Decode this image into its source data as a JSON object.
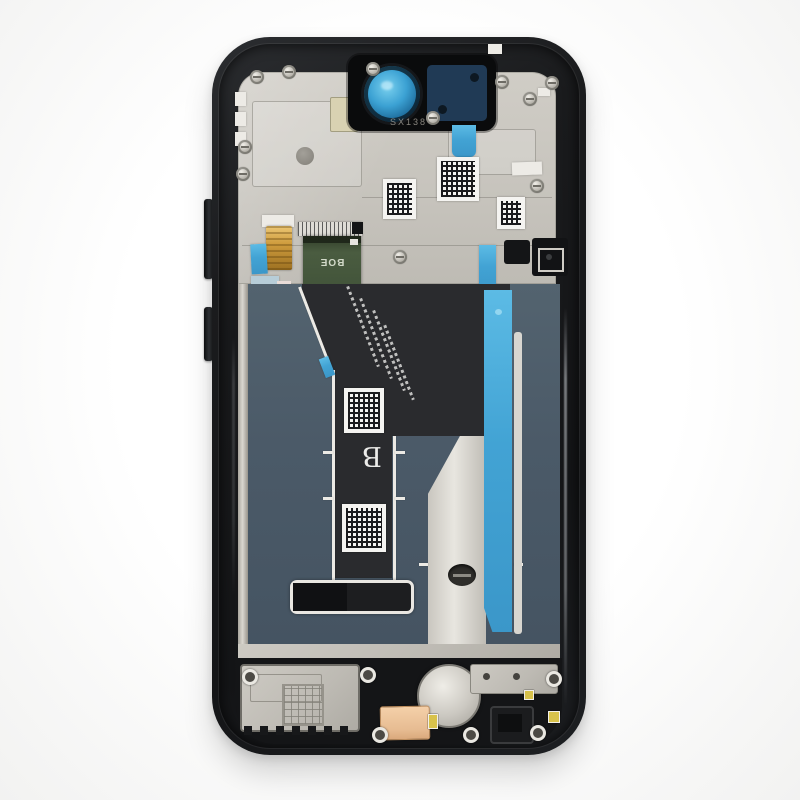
{
  "scene": {
    "type": "product-photo",
    "subject": "Smartphone LCD display assembly with frame, rear view",
    "background_color": "#fafafa"
  },
  "markings": {
    "pcb_brand": "BOE",
    "frame_stamp": "SX138",
    "flex_letter": "B"
  },
  "colors": {
    "frame_black": "#17181a",
    "metal_plate_silver": "#c9c6bf",
    "display_back_panel": "#4b5a68",
    "flex_ribbon_dark": "#2a2b2e",
    "adhesive_tape_blue": "#42a3d4",
    "pcb_green": "#45573c",
    "camera_lens_blue": "#3ba1d3",
    "contact_pad_copper": "#ecc49c"
  }
}
